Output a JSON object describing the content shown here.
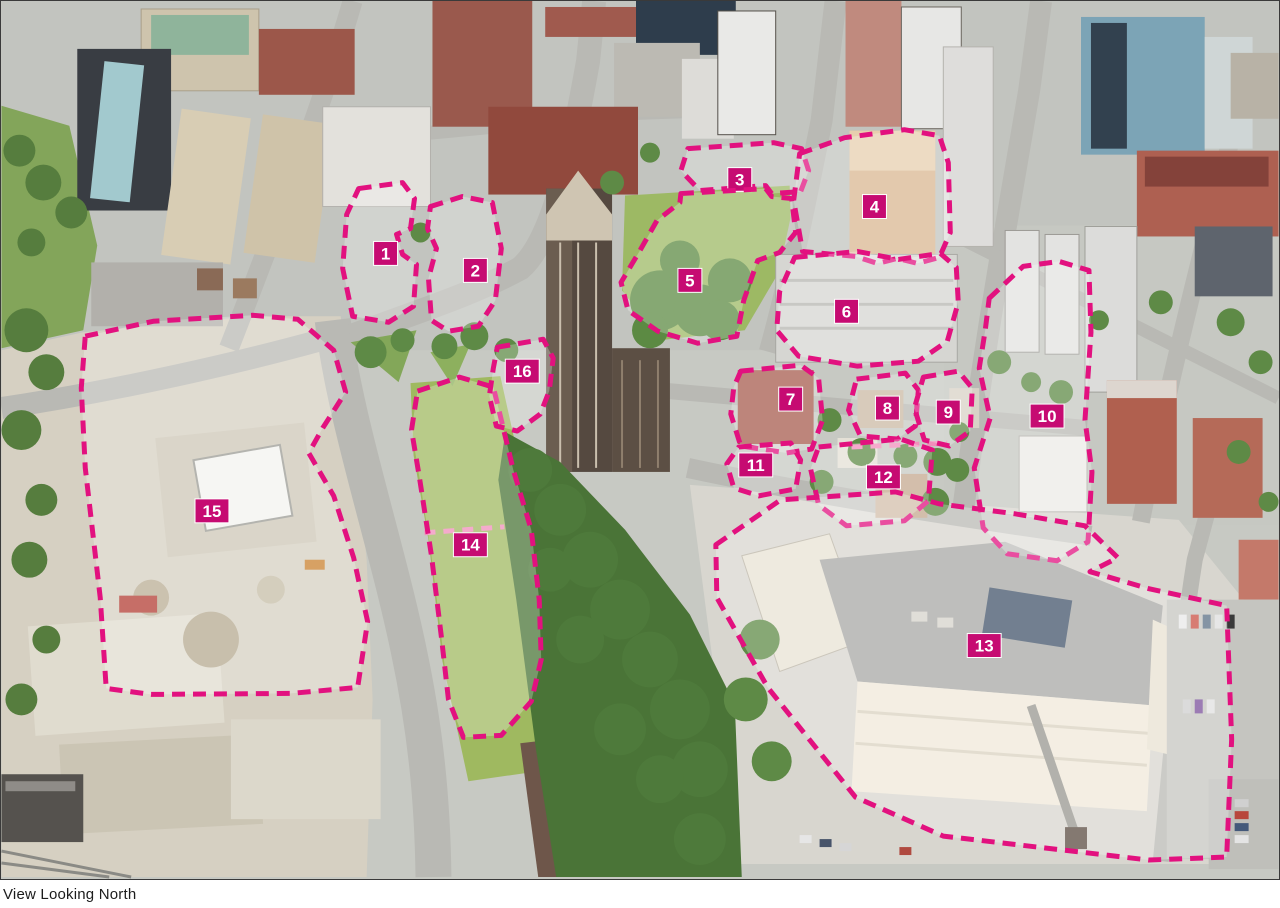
{
  "caption": {
    "text": "View Looking North"
  },
  "colors": {
    "outline": "#e2117f",
    "outline_light": "#f18ebb",
    "badge_bg": "#c60b72",
    "badge_text": "#ffffff"
  },
  "sites": [
    {
      "id": "1",
      "badge": [
        385,
        253
      ],
      "polygon": "358,188 402,182 414,198 410,228 396,234 402,254 416,264 413,306 388,322 352,316 342,268 346,214"
    },
    {
      "id": "2",
      "badge": [
        475,
        270
      ],
      "polygon": "430,206 462,196 492,202 501,248 495,300 478,326 448,331 431,320 428,278 436,248 427,228"
    },
    {
      "id": "3",
      "badge": [
        740,
        179
      ],
      "polygon": "688,148 774,142 802,148 809,170 801,191 772,193 766,185 700,190 681,170"
    },
    {
      "id": "4",
      "badge": [
        875,
        206
      ],
      "polygon": "800,153 845,137 905,129 940,135 949,162 951,232 940,257 918,263 898,258 878,263 856,256 803,251 794,200"
    },
    {
      "id": "5",
      "badge": [
        690,
        280
      ],
      "polygon": "681,193 766,188 772,196 792,198 796,232 780,252 758,260 744,300 737,336 698,343 658,331 628,310 621,282 640,250 657,220 680,202"
    },
    {
      "id": "6",
      "badge": [
        847,
        311
      ],
      "polygon": "795,257 858,251 899,259 941,253 957,267 959,302 948,341 919,361 858,366 799,356 777,330 780,291"
    },
    {
      "id": "7",
      "badge": [
        791,
        399
      ],
      "polygon": "741,371 801,365 819,378 823,420 812,449 787,453 741,446 731,414 734,387"
    },
    {
      "id": "8",
      "badge": [
        888,
        408
      ],
      "polygon": "857,379 906,373 919,390 916,426 898,439 861,436 849,410"
    },
    {
      "id": "9",
      "badge": [
        949,
        412
      ],
      "polygon": "924,377 959,371 973,388 971,431 950,446 925,440 915,408"
    },
    {
      "id": "10",
      "badge": [
        1048,
        416
      ],
      "polygon": "990,298 1024,266 1060,261 1090,270 1092,332 1086,420 1093,472 1089,542 1058,561 1008,554 984,528 975,468 991,418 980,368 986,330"
    },
    {
      "id": "11",
      "badge": [
        756,
        465
      ],
      "polygon": "739,447 791,443 801,460 796,489 759,496 734,488 727,464"
    },
    {
      "id": "12",
      "badge": [
        884,
        477
      ],
      "polygon": "819,447 901,439 933,450 929,501 905,521 847,526 819,505 811,469"
    },
    {
      "id": "13",
      "badge": [
        985,
        646
      ],
      "polygon": "716,545 781,500 896,492 940,504 1016,514 1086,526 1119,558 1091,572 1150,589 1228,606 1233,740 1228,858 1150,861 944,837 856,798 768,688 717,598"
    },
    {
      "id": "14",
      "badge": [
        470,
        545
      ],
      "polygon": "417,391 459,377 493,387 501,420 513,470 531,530 539,600 541,660 531,702 501,736 463,738 448,700 441,638 431,556 419,478 411,430"
    },
    {
      "id": "15",
      "badge": [
        211,
        511
      ],
      "polygon": "84,336 152,321 252,315 297,319 333,350 345,392 322,428 308,453 333,496 353,558 367,622 357,688 290,694 150,695 105,689 99,598 84,468 80,388"
    },
    {
      "id": "16",
      "badge": [
        522,
        371
      ],
      "polygon": "497,347 543,339 553,358 549,391 540,414 517,431 496,426 489,396 493,368"
    }
  ],
  "dividers": [
    {
      "points": "424,533 504,527"
    },
    {
      "points": "852,447 948,443"
    }
  ]
}
